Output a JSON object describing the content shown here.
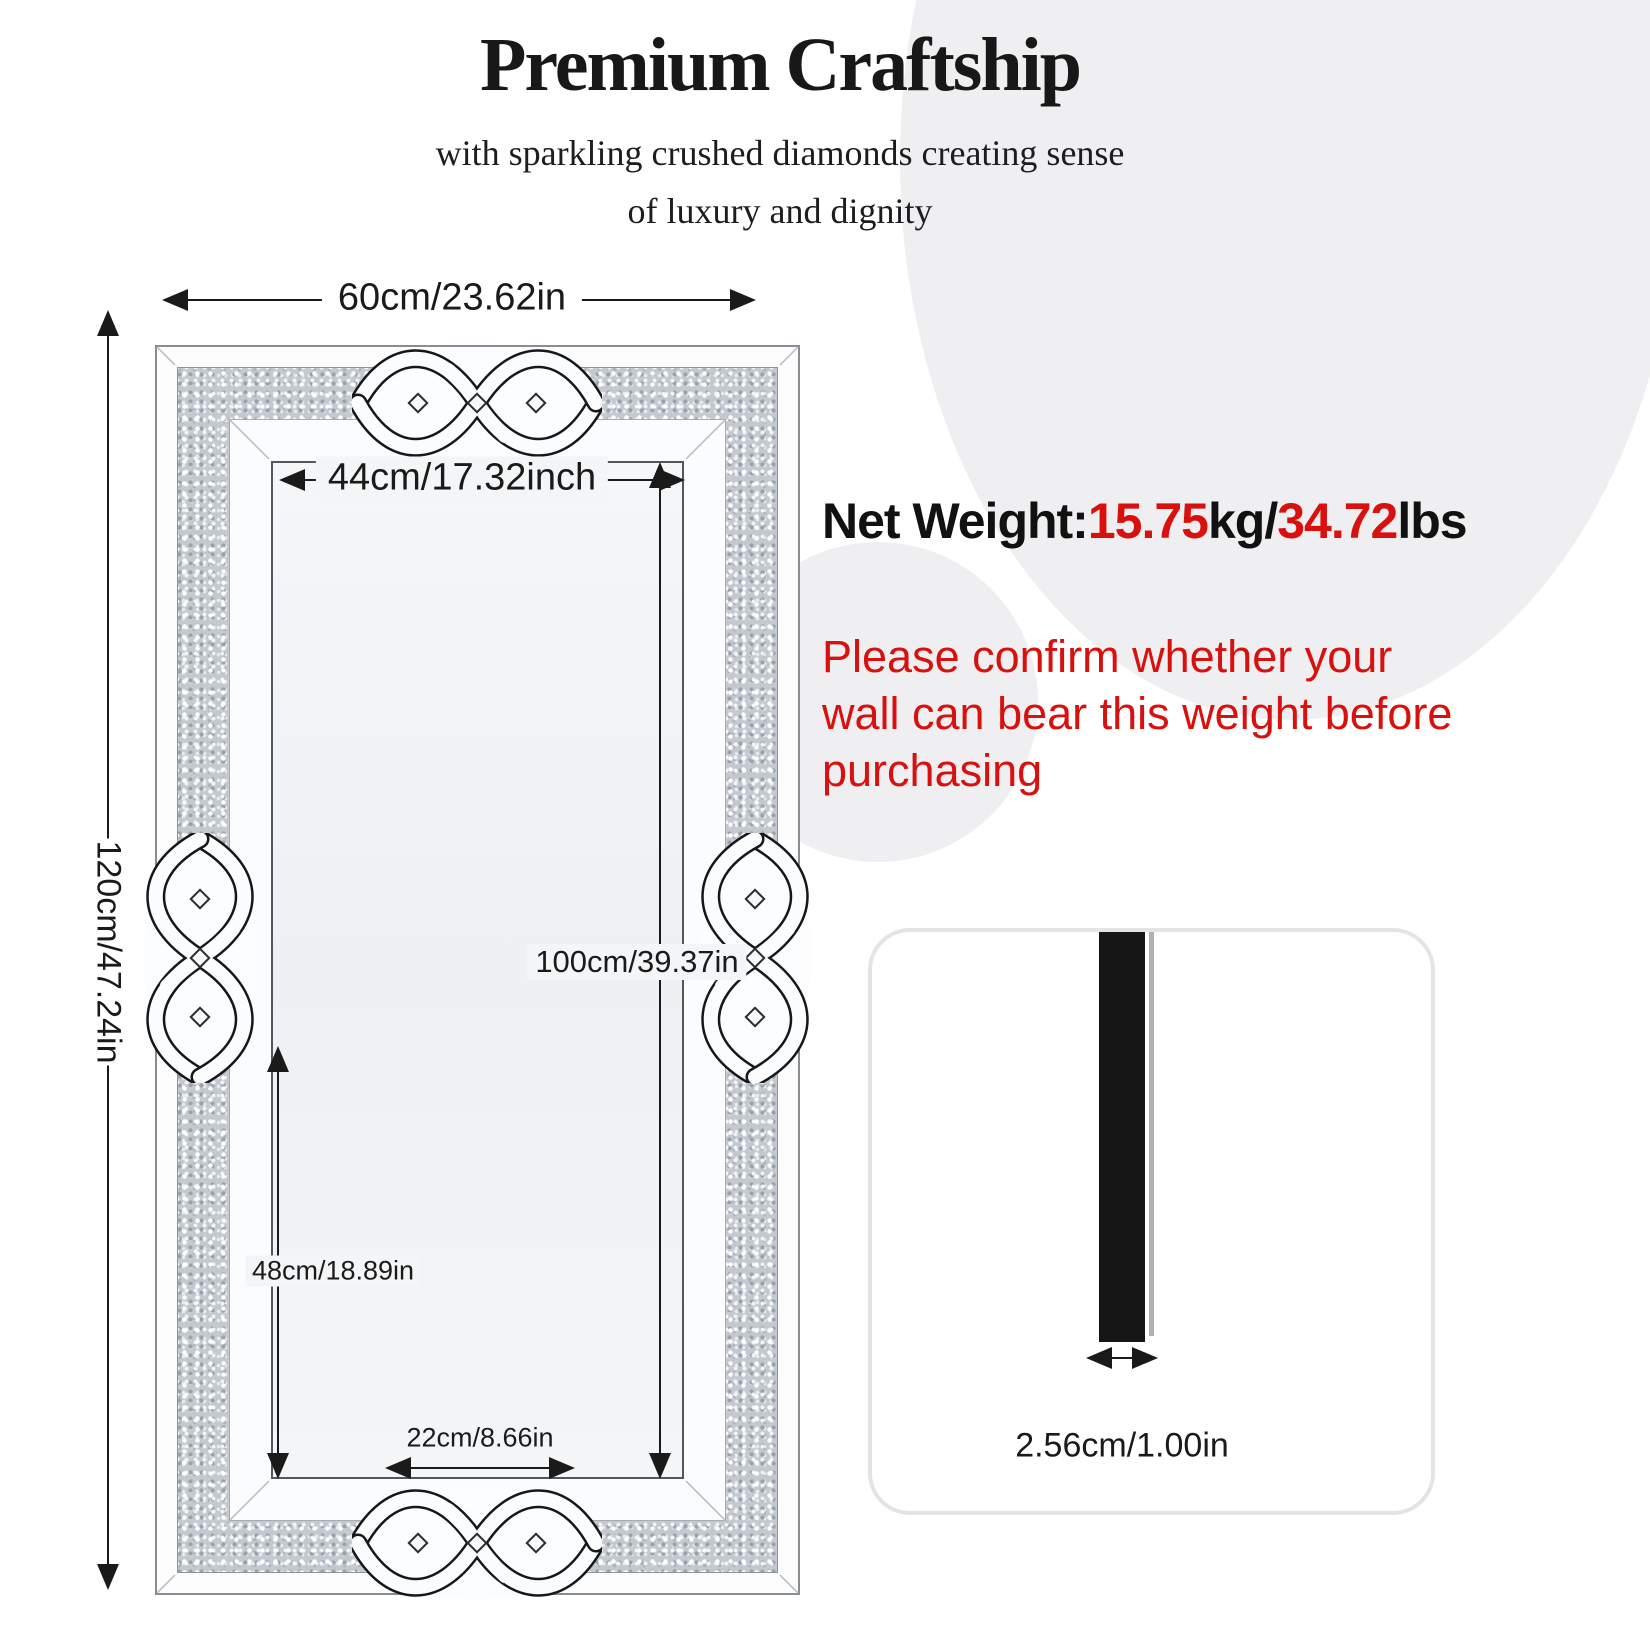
{
  "header": {
    "title": "Premium Craftship",
    "subtitle_line1": "with sparkling crushed diamonds creating sense",
    "subtitle_line2": "of luxury and dignity"
  },
  "weight": {
    "label": "Net Weight:",
    "value_kg": "15.75",
    "unit_kg": "kg/",
    "value_lbs": "34.72",
    "unit_lbs": "lbs"
  },
  "warning": {
    "line1": "Please confirm whether your",
    "line2": "wall can bear this weight before",
    "line3": "purchasing"
  },
  "dimensions": {
    "overall_width": "60cm/23.62in",
    "overall_height": "120cm/47.24in",
    "inner_width": "44cm/17.32inch",
    "inner_height": "100cm/39.37in",
    "partial_height": "48cm/18.89in",
    "bottom_width": "22cm/8.66in"
  },
  "thickness_panel": {
    "thickness": "2.56cm/1.00in"
  },
  "colors": {
    "accent_red": "#d8100e",
    "text_black": "#111111",
    "circle_gray": "#efeff1",
    "diamond_band_gray": "#c3c9cf"
  }
}
